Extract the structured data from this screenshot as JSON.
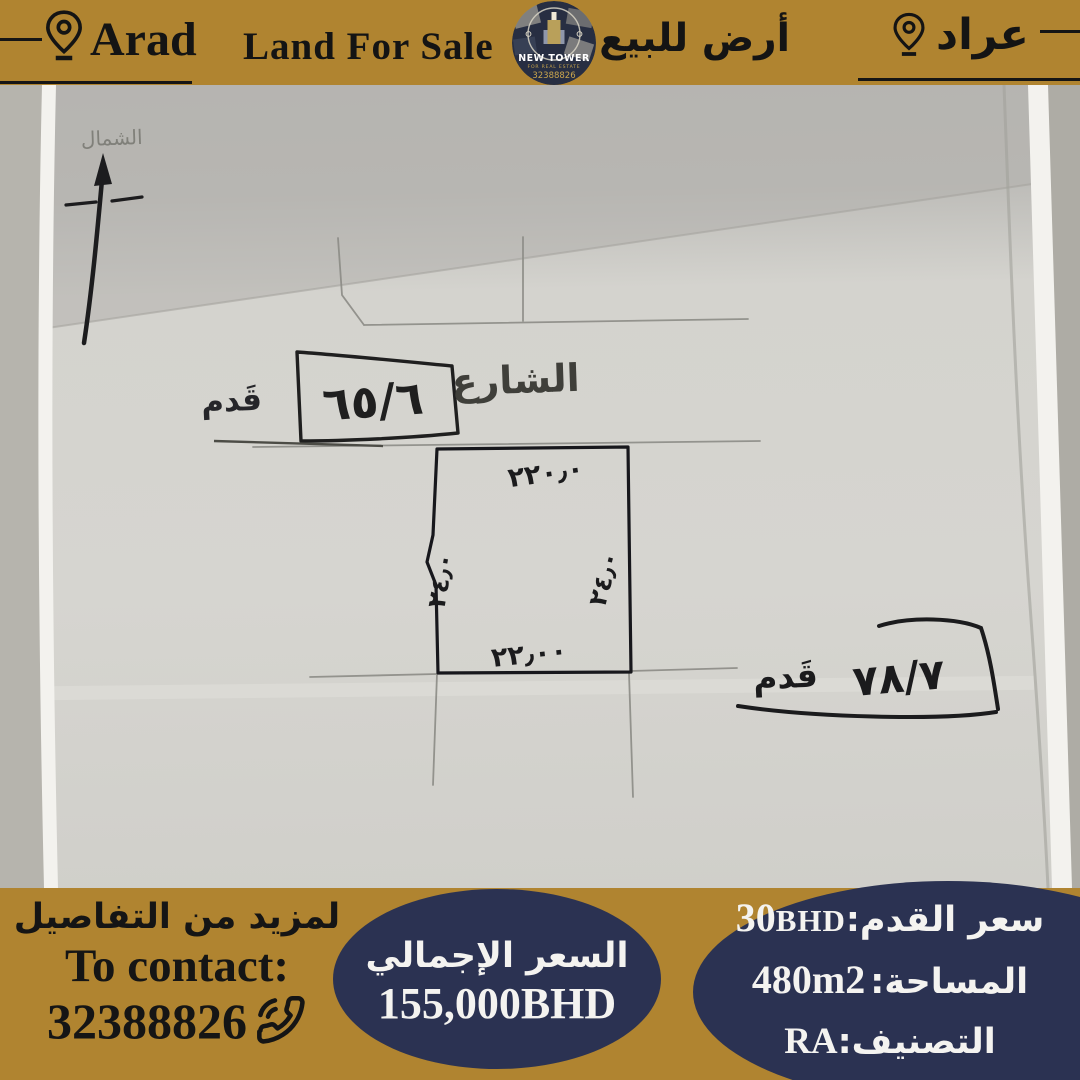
{
  "theme": {
    "gold": "#b08430",
    "navy": "#2b3252",
    "ink": "#151515",
    "paper": "#d4d3ce",
    "white_text": "#f4f3f0"
  },
  "header": {
    "location_en": "Arad",
    "title_en": "Land For Sale",
    "title_ar": "أرض للبيع",
    "location_ar": "عراد",
    "logo": {
      "name": "NEW TOWER",
      "tagline": "FOR REAL ESTATE",
      "phone": "32388826"
    }
  },
  "sketch": {
    "north_label": "الشمال",
    "street_label": "الشارع",
    "parcel_left": {
      "number": "٦٥/٦",
      "unit": "قَدم"
    },
    "parcel_right": {
      "number": "٧٨/٧",
      "unit": "قَدم"
    },
    "dims": {
      "top": "٢٢٠٫٠",
      "bottom": "٢٢٫٠٠",
      "left": "٢٤٫٠",
      "right": "٢٤٫٠"
    }
  },
  "footer": {
    "contact": {
      "more_details_ar": "لمزيد من التفاصيل",
      "to_contact_en": "To contact:",
      "phone": "32388826"
    },
    "total": {
      "label_ar": "السعر الإجمالي",
      "value": "155,000BHD"
    },
    "details": {
      "price_label": "سعر القدم:",
      "price_value": "30",
      "price_currency": "BHD",
      "area_label": "المساحة:",
      "area_value": "480m2",
      "class_label": "التصنيف:",
      "class_value": "RA"
    }
  }
}
